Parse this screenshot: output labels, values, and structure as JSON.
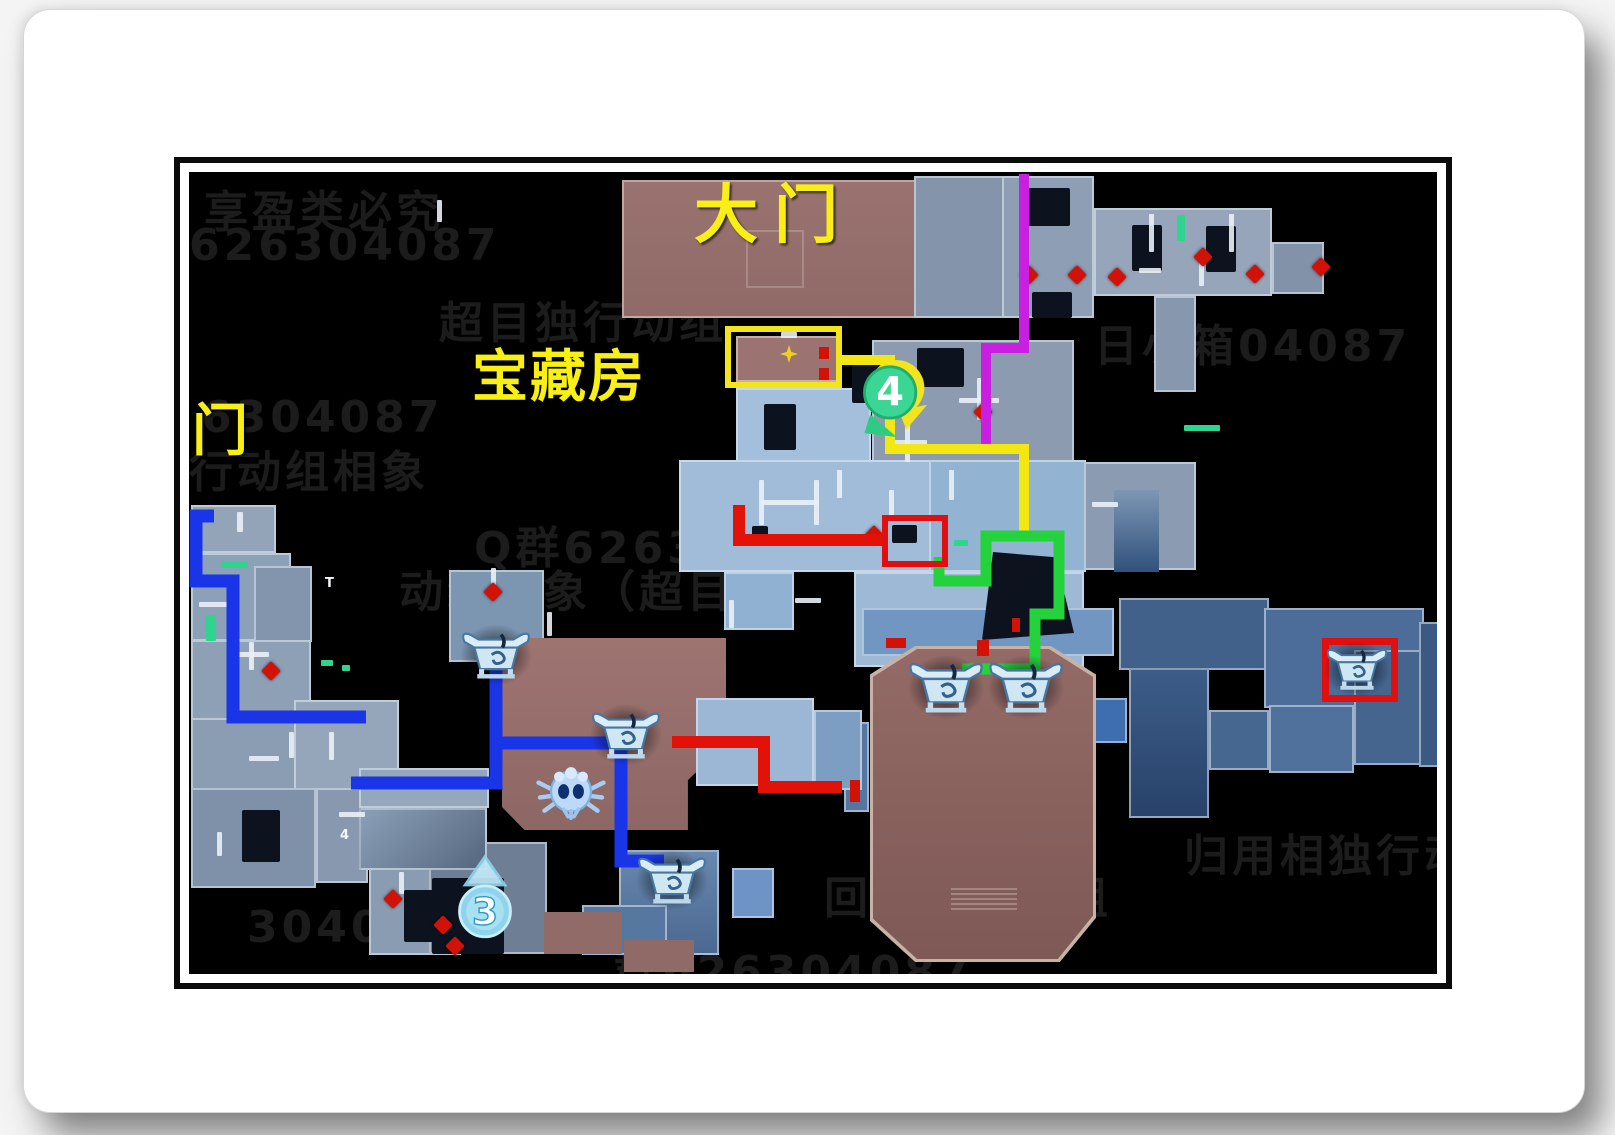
{
  "labels": {
    "gate": {
      "text": "大门",
      "x": 505,
      "y": -8,
      "size": 64,
      "spacing": 16
    },
    "treasure": {
      "text": "宝藏房",
      "x": 283,
      "y": 160,
      "size": 56,
      "spacing": 2
    },
    "side": {
      "text": "侧门",
      "x": -55,
      "y": 214,
      "size": 56,
      "spacing": 2
    },
    "marker4": "4",
    "marker3": "3",
    "micro": [
      {
        "text": "T",
        "x": 136,
        "y": 404
      },
      {
        "text": "4",
        "x": 151,
        "y": 656
      }
    ]
  },
  "colors": {
    "route_blue": "#1a35e8",
    "route_red": "#e31208",
    "route_yellow": "#f3e713",
    "route_green": "#24d33c",
    "route_magenta": "#c81fe0",
    "highlight_yellow": "#f2e51c",
    "highlight_red": "#e01010",
    "label_yellow": "#f7ef15",
    "room_brown": "#97706d",
    "room_blue": "#9fbbd8"
  },
  "map": {
    "watermarks": [
      {
        "x": 15,
        "y": 4,
        "t": "享盈类必究"
      },
      {
        "x": 0,
        "y": 48,
        "t": "626304087"
      },
      {
        "x": 12,
        "y": 220,
        "t": "6304087"
      },
      {
        "x": 0,
        "y": 264,
        "t": "行动组相象"
      },
      {
        "x": 285,
        "y": 340,
        "t": "Q群626304087"
      },
      {
        "x": 210,
        "y": 384,
        "t": "动组棚象（超目独"
      },
      {
        "x": 905,
        "y": 138,
        "t": "日小箱04087"
      },
      {
        "x": 635,
        "y": 690,
        "t": "回目独行动组"
      },
      {
        "x": 995,
        "y": 648,
        "t": "归用相独行动"
      },
      {
        "x": 58,
        "y": 730,
        "t": "304087"
      },
      {
        "x": 425,
        "y": 764,
        "t": "群626304087"
      },
      {
        "x": 250,
        "y": 115,
        "t": "超目独行动组"
      }
    ],
    "rooms": [
      {
        "x": 433,
        "y": 8,
        "w": 302,
        "h": 138,
        "bg": "linear-gradient(180deg,#9a7370,#8f6a67)",
        "bd": "2px solid rgba(228,212,204,0.55)"
      },
      {
        "x": 557,
        "y": 58,
        "w": 58,
        "h": 58,
        "bg": "transparent",
        "bd": "2px solid rgba(235,225,220,0.25)"
      },
      {
        "x": 725,
        "y": 4,
        "w": 158,
        "h": 142,
        "bg": "#8494aa"
      },
      {
        "x": 813,
        "y": 4,
        "w": 92,
        "h": 142,
        "bg": "#8e9eb4"
      },
      {
        "x": 905,
        "y": 36,
        "w": 178,
        "h": 88,
        "bg": "#96a5b9"
      },
      {
        "x": 1083,
        "y": 70,
        "w": 52,
        "h": 52,
        "bg": "#8292a8"
      },
      {
        "x": 965,
        "y": 124,
        "w": 42,
        "h": 96,
        "bg": "#8797ad"
      },
      {
        "x": 683,
        "y": 168,
        "w": 202,
        "h": 130,
        "bg": "#8c9bb0"
      },
      {
        "x": 547,
        "y": 164,
        "w": 105,
        "h": 46,
        "bg": "#9b7471",
        "bd": "2px solid rgba(230,215,208,0.6)"
      },
      {
        "x": 547,
        "y": 216,
        "w": 135,
        "h": 74,
        "bg": "#a4bfdb"
      },
      {
        "x": 490,
        "y": 288,
        "w": 252,
        "h": 112,
        "bg": "#a0bcd9"
      },
      {
        "x": 740,
        "y": 288,
        "w": 157,
        "h": 112,
        "bg": "#93b3d3"
      },
      {
        "x": 895,
        "y": 290,
        "w": 112,
        "h": 108,
        "bg": "#8b9cb2"
      },
      {
        "x": 925,
        "y": 318,
        "w": 45,
        "h": 82,
        "bg": "linear-gradient(180deg,#7d97b4,#31517c)",
        "bd": "none"
      },
      {
        "x": 535,
        "y": 400,
        "w": 70,
        "h": 58,
        "bg": "#90b1d1"
      },
      {
        "x": 665,
        "y": 400,
        "w": 230,
        "h": 95,
        "bg": "#9db9d5"
      },
      {
        "x": 673,
        "y": 436,
        "w": 252,
        "h": 48,
        "bg": "#7296c2"
      },
      {
        "x": 655,
        "y": 550,
        "w": 25,
        "h": 90,
        "bg": "#55779f"
      },
      {
        "x": 903,
        "y": 526,
        "w": 35,
        "h": 45,
        "bg": "#3e6eae"
      },
      {
        "x": 930,
        "y": 426,
        "w": 150,
        "h": 72,
        "bg": "#41608a"
      },
      {
        "x": 1075,
        "y": 436,
        "w": 160,
        "h": 100,
        "bg": "#4c6d99"
      },
      {
        "x": 940,
        "y": 496,
        "w": 80,
        "h": 150,
        "bg": "linear-gradient(180deg,#3c5d88,#28426a)"
      },
      {
        "x": 1020,
        "y": 538,
        "w": 60,
        "h": 60,
        "bg": "#46678f"
      },
      {
        "x": 1080,
        "y": 533,
        "w": 85,
        "h": 68,
        "bg": "#50719c"
      },
      {
        "x": 1165,
        "y": 478,
        "w": 70,
        "h": 115,
        "bg": "#45658e"
      },
      {
        "x": 1230,
        "y": 450,
        "w": 28,
        "h": 145,
        "bg": "#3a5a84"
      },
      {
        "x": 2,
        "y": 333,
        "w": 85,
        "h": 48,
        "bg": "#93a3b8"
      },
      {
        "x": 2,
        "y": 381,
        "w": 100,
        "h": 88,
        "bg": "#8ca0b8"
      },
      {
        "x": 65,
        "y": 394,
        "w": 58,
        "h": 76,
        "bg": "#8395ac"
      },
      {
        "x": 2,
        "y": 468,
        "w": 120,
        "h": 80,
        "bg": "#8da0b6"
      },
      {
        "x": 2,
        "y": 546,
        "w": 178,
        "h": 72,
        "bg": "#8b9db3"
      },
      {
        "x": 105,
        "y": 528,
        "w": 105,
        "h": 90,
        "bg": "#95a6bb"
      },
      {
        "x": 2,
        "y": 616,
        "w": 125,
        "h": 100,
        "bg": "#7e91a8"
      },
      {
        "x": 127,
        "y": 616,
        "w": 52,
        "h": 95,
        "bg": "#8899af"
      },
      {
        "x": 180,
        "y": 693,
        "w": 92,
        "h": 90,
        "bg": "#8a9cb2"
      },
      {
        "x": 240,
        "y": 670,
        "w": 118,
        "h": 112,
        "bg": "#6e7f95"
      },
      {
        "x": 170,
        "y": 596,
        "w": 130,
        "h": 40,
        "bg": "#94a7bd"
      },
      {
        "x": 170,
        "y": 636,
        "w": 128,
        "h": 62,
        "bg": "linear-gradient(135deg,#8ba0b8,#55677e)"
      },
      {
        "x": 260,
        "y": 398,
        "w": 95,
        "h": 92,
        "bg": "#7c96b1"
      },
      {
        "x": 313,
        "y": 466,
        "w": 224,
        "h": 192,
        "bg": "linear-gradient(180deg,#9e7471,#8d6764)",
        "clip": "polygon(0 0,100% 0,100% 55%,83% 74%,83% 100%,10% 100%,0 88%)"
      },
      {
        "x": 507,
        "y": 526,
        "w": 118,
        "h": 88,
        "bg": "#9bb7d5"
      },
      {
        "x": 625,
        "y": 538,
        "w": 48,
        "h": 80,
        "bg": "#7c9ec2"
      },
      {
        "x": 430,
        "y": 678,
        "w": 100,
        "h": 105,
        "bg": "linear-gradient(180deg,#6888ae,#4a6890)"
      },
      {
        "x": 393,
        "y": 733,
        "w": 85,
        "h": 50,
        "bg": "#56779f"
      },
      {
        "x": 355,
        "y": 740,
        "w": 78,
        "h": 42,
        "bg": "#906b68",
        "bd": "none"
      },
      {
        "x": 435,
        "y": 768,
        "w": 70,
        "h": 32,
        "bg": "#8f6a67",
        "bd": "none"
      },
      {
        "x": 543,
        "y": 696,
        "w": 42,
        "h": 50,
        "bg": "#6d94c4"
      },
      {
        "x": 681,
        "y": 474,
        "w": 226,
        "h": 316,
        "bg": "#c8b2a5",
        "clip": "polygon(20% 0,80% 0,100% 9%,100% 86%,84% 100%,20% 100%,0 87%,0 9%)"
      },
      {
        "x": 684,
        "y": 477,
        "w": 220,
        "h": 310,
        "bg": "linear-gradient(180deg,#936a66,#7e5955)",
        "clip": "polygon(20% 0,80% 0,100% 9%,100% 86%,84% 100%,20% 100%,0 87%,0 9%)"
      }
    ],
    "desks": [
      {
        "x": 833,
        "y": 16,
        "w": 48,
        "h": 38
      },
      {
        "x": 843,
        "y": 120,
        "w": 40,
        "h": 26
      },
      {
        "x": 943,
        "y": 53,
        "w": 30,
        "h": 46
      },
      {
        "x": 1017,
        "y": 54,
        "w": 30,
        "h": 46
      },
      {
        "x": 728,
        "y": 176,
        "w": 47,
        "h": 39
      },
      {
        "x": 663,
        "y": 193,
        "w": 29,
        "h": 38
      },
      {
        "x": 563,
        "y": 354,
        "w": 16,
        "h": 11
      },
      {
        "x": 703,
        "y": 353,
        "w": 25,
        "h": 18
      },
      {
        "x": 575,
        "y": 232,
        "w": 32,
        "h": 46
      },
      {
        "x": 53,
        "y": 638,
        "w": 38,
        "h": 52
      },
      {
        "x": 215,
        "y": 718,
        "w": 35,
        "h": 52
      },
      {
        "x": 243,
        "y": 706,
        "w": 72,
        "h": 76
      },
      {
        "x": 793,
        "y": 380,
        "w": 92,
        "h": 88,
        "clip": "polygon(12% 0,80% 6%,100% 92%,0 100%)"
      }
    ],
    "ticks": [
      [
        48,
        340,
        6,
        20
      ],
      [
        10,
        430,
        40,
        5
      ],
      [
        60,
        470,
        5,
        28
      ],
      [
        44,
        480,
        36,
        5
      ],
      [
        100,
        560,
        5,
        26
      ],
      [
        60,
        584,
        30,
        5
      ],
      [
        140,
        560,
        5,
        28
      ],
      [
        28,
        660,
        5,
        24
      ],
      [
        150,
        640,
        26,
        5
      ],
      [
        210,
        700,
        5,
        22
      ],
      [
        570,
        308,
        5,
        45
      ],
      [
        625,
        308,
        5,
        45
      ],
      [
        572,
        328,
        58,
        5
      ],
      [
        960,
        42,
        5,
        38
      ],
      [
        1040,
        42,
        5,
        38
      ],
      [
        770,
        226,
        40,
        5
      ],
      [
        788,
        206,
        5,
        42
      ],
      [
        248,
        28,
        5,
        22
      ],
      [
        592,
        160,
        16,
        6
      ],
      [
        700,
        318,
        5,
        26
      ],
      [
        648,
        298,
        5,
        28
      ],
      [
        540,
        428,
        5,
        28
      ],
      [
        606,
        426,
        26,
        5
      ],
      [
        760,
        298,
        5,
        30
      ],
      [
        903,
        330,
        26,
        5
      ],
      [
        1010,
        88,
        5,
        26
      ],
      [
        950,
        96,
        22,
        5
      ],
      [
        700,
        268,
        38,
        5
      ],
      [
        716,
        250,
        5,
        40
      ],
      [
        358,
        440,
        5,
        24
      ],
      [
        302,
        396,
        5,
        20
      ]
    ],
    "doors": [
      [
        988,
        43,
        8,
        26
      ],
      [
        33,
        389,
        26,
        7
      ],
      [
        17,
        443,
        10,
        26
      ],
      [
        995,
        253,
        36,
        6
      ],
      [
        765,
        368,
        14,
        6
      ],
      [
        792,
        368,
        10,
        6
      ],
      [
        132,
        488,
        12,
        6
      ],
      [
        153,
        493,
        8,
        6
      ]
    ],
    "diamonds": [
      [
        833,
        96
      ],
      [
        881,
        96
      ],
      [
        921,
        98
      ],
      [
        1007,
        78
      ],
      [
        1059,
        95
      ],
      [
        1125,
        88
      ],
      [
        297,
        413
      ],
      [
        75,
        492
      ],
      [
        197,
        720
      ],
      [
        247,
        746
      ],
      [
        259,
        767
      ],
      [
        787,
        233
      ],
      [
        678,
        356
      ]
    ],
    "marks": [
      [
        630,
        175,
        10,
        12
      ],
      [
        630,
        196,
        10,
        12
      ],
      [
        697,
        466,
        20,
        10
      ],
      [
        788,
        468,
        12,
        16
      ],
      [
        661,
        608,
        10,
        22
      ],
      [
        823,
        446,
        8,
        14
      ]
    ],
    "star": {
      "x": 591,
      "y": 173,
      "w": 18,
      "h": 18
    },
    "routes": [
      {
        "name": "route-blue-west",
        "color": "#1a35e8",
        "w": 13,
        "pts": [
          [
            25,
            344
          ],
          [
            7,
            344
          ],
          [
            7,
            409
          ],
          [
            44,
            409
          ],
          [
            44,
            545
          ],
          [
            177,
            545
          ]
        ]
      },
      {
        "name": "route-blue-chest-a",
        "color": "#1a35e8",
        "w": 13,
        "pts": [
          [
            162,
            611
          ],
          [
            307,
            611
          ],
          [
            307,
            485
          ]
        ]
      },
      {
        "name": "route-blue-chest-c",
        "color": "#1a35e8",
        "w": 13,
        "pts": [
          [
            307,
            571
          ],
          [
            432,
            571
          ],
          [
            432,
            689
          ],
          [
            475,
            689
          ]
        ]
      },
      {
        "name": "route-red-desk",
        "color": "#e31208",
        "w": 12,
        "pts": [
          [
            550,
            333
          ],
          [
            550,
            368
          ],
          [
            693,
            368
          ]
        ]
      },
      {
        "name": "route-red-east",
        "color": "#e31208",
        "w": 12,
        "pts": [
          [
            483,
            570
          ],
          [
            575,
            570
          ],
          [
            575,
            615
          ],
          [
            653,
            615
          ]
        ]
      },
      {
        "name": "route-magenta",
        "color": "#c81fe0",
        "w": 10,
        "pts": [
          [
            835,
            2
          ],
          [
            835,
            176
          ],
          [
            797,
            176
          ],
          [
            797,
            276
          ]
        ]
      },
      {
        "name": "route-yellow",
        "color": "#f3e713",
        "w": 10,
        "pts": [
          [
            653,
            188
          ],
          [
            701,
            188
          ],
          [
            701,
            277
          ],
          [
            835,
            277
          ],
          [
            835,
            362
          ]
        ]
      },
      {
        "name": "route-green",
        "color": "#24d33c",
        "w": 11,
        "pts": [
          [
            750,
            385
          ],
          [
            750,
            409
          ],
          [
            797,
            409
          ],
          [
            797,
            364
          ],
          [
            870,
            364
          ],
          [
            870,
            442
          ],
          [
            846,
            442
          ],
          [
            846,
            497
          ],
          [
            773,
            497
          ]
        ]
      }
    ],
    "highlights": [
      {
        "name": "treasure-room-highlight-box",
        "x": 536,
        "y": 154,
        "w": 117,
        "h": 62,
        "color": "#f2e51c",
        "bw": 6
      },
      {
        "name": "desk-highlight-box",
        "x": 693,
        "y": 343,
        "w": 66,
        "h": 52,
        "color": "#e01010",
        "bw": 6
      },
      {
        "name": "chest-highlight-box",
        "x": 1133,
        "y": 466,
        "w": 76,
        "h": 64,
        "color": "#e01010",
        "bw": 7
      }
    ],
    "chests": [
      {
        "x": 271,
        "y": 450,
        "w": 72,
        "h": 64
      },
      {
        "x": 401,
        "y": 530,
        "w": 72,
        "h": 64
      },
      {
        "x": 447,
        "y": 676,
        "w": 72,
        "h": 62
      },
      {
        "x": 718,
        "y": 480,
        "w": 78,
        "h": 68
      },
      {
        "x": 798,
        "y": 480,
        "w": 78,
        "h": 68
      },
      {
        "x": 1136,
        "y": 468,
        "w": 64,
        "h": 56
      }
    ],
    "markers": {
      "m4": {
        "x": 666,
        "y": 185,
        "w": 76,
        "h": 88
      },
      "m3": {
        "x": 263,
        "y": 682,
        "w": 66,
        "h": 92
      }
    },
    "spider": {
      "x": 345,
      "y": 590,
      "w": 74,
      "h": 62
    },
    "vents": {
      "x": 762,
      "y": 716,
      "w": 66,
      "h": 22
    }
  }
}
